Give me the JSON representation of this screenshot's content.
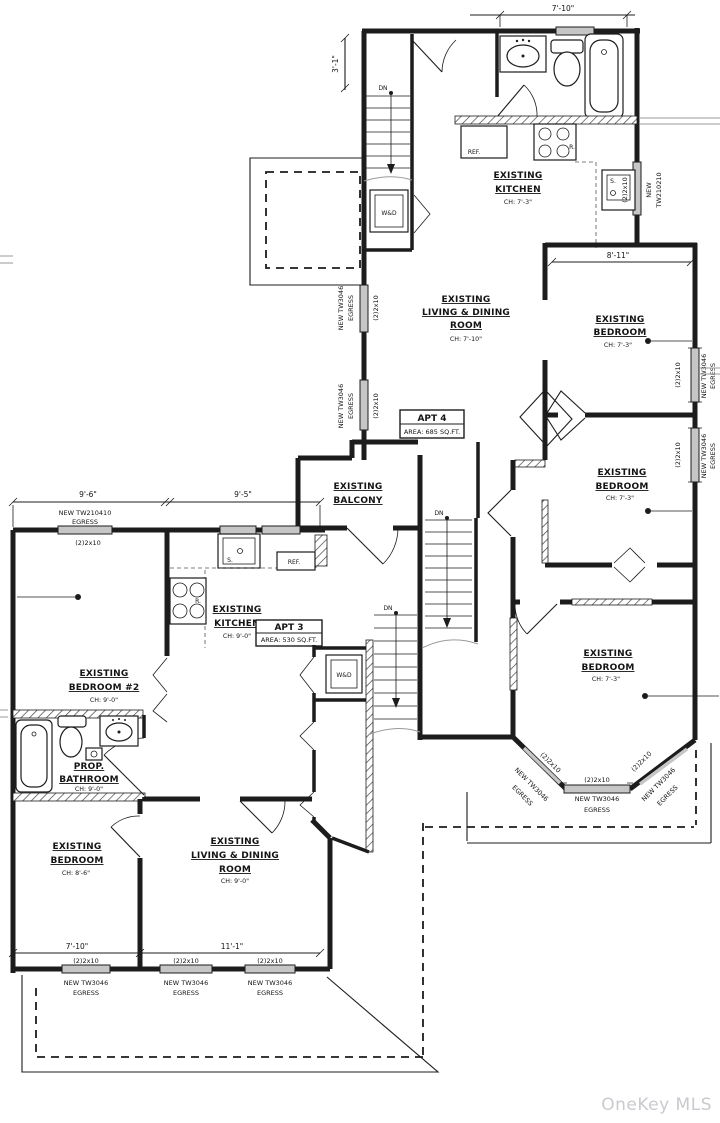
{
  "watermark": "OneKey MLS",
  "fixtures": {
    "dn": "DN",
    "wd": "W&D",
    "ref": "REF.",
    "range": "R.",
    "sink": "S."
  },
  "apt4": {
    "unit": {
      "title": "APT 4",
      "area": "AREA: 685 SQ.FT."
    },
    "kitchen": {
      "line1": "EXISTING",
      "line2": "KITCHEN",
      "ch": "CH: 7'-3\""
    },
    "living": {
      "line1": "EXISTING",
      "line2": "LIVING & DINING",
      "line3": "ROOM",
      "ch": "CH: 7'-10\""
    },
    "bedroom_right_top": {
      "line1": "EXISTING",
      "line2": "BEDROOM",
      "ch": "CH: 7'-3\""
    },
    "bedroom_right_mid": {
      "line1": "EXISTING",
      "line2": "BEDROOM",
      "ch": "CH: 7'-3\""
    },
    "bedroom_right_bottom": {
      "line1": "EXISTING",
      "line2": "BEDROOM",
      "ch": "CH: 7'-3\""
    },
    "balcony": {
      "line1": "EXISTING",
      "line2": "BALCONY"
    }
  },
  "apt3": {
    "unit": {
      "title": "APT 3",
      "area": "AREA: 530 SQ.FT."
    },
    "kitchen": {
      "line1": "EXISTING",
      "line2": "KITCHEN",
      "ch": "CH: 9'-0\""
    },
    "bedroom2": {
      "line1": "EXISTING",
      "line2": "BEDROOM #2",
      "ch": "CH: 9'-0\""
    },
    "bathroom": {
      "line1": "PROP.",
      "line2": "BATHROOM",
      "ch": "CH: 9'-0\""
    },
    "bedroom": {
      "line1": "EXISTING",
      "line2": "BEDROOM",
      "ch": "CH: 8'-6\""
    },
    "living": {
      "line1": "EXISTING",
      "line2": "LIVING & DINING",
      "line3": "ROOM",
      "ch": "CH: 9'-0\""
    }
  },
  "dims": {
    "top_width": "7'-10\"",
    "top_left_height": "3'-1\"",
    "bedroom_width": "8'-11\"",
    "apt3_top_left": "9'-6\"",
    "apt3_top_right": "9'-5\"",
    "bottom_left": "7'-10\"",
    "bottom_right": "11'-1\""
  },
  "windows": {
    "header": "(2)2x10",
    "tw3046": "NEW TW3046",
    "egress": "EGRESS",
    "tw210210_l1": "NEW",
    "tw210210_l2": "TW210210",
    "tw210410": "NEW TW210410"
  }
}
